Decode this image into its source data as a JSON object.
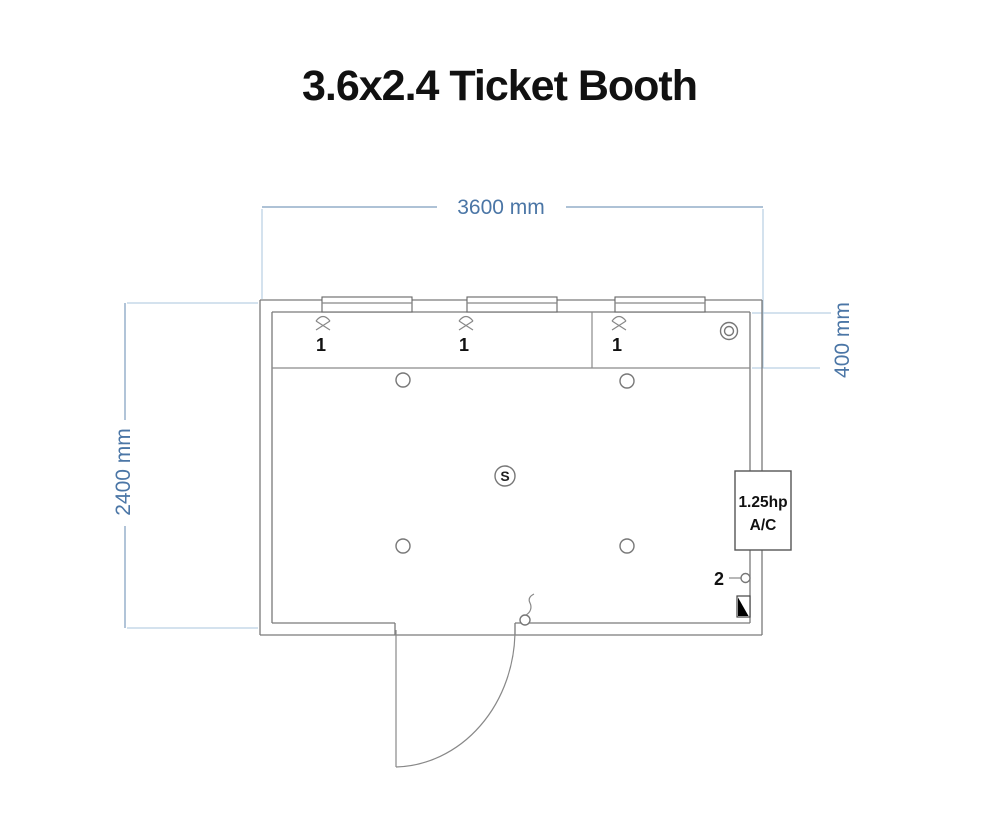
{
  "page": {
    "title": "3.6x2.4 Ticket Booth"
  },
  "dimensions": {
    "width_label": "3600 mm",
    "height_label": "2400 mm",
    "counter_depth_label": "400 mm"
  },
  "windows": [
    {
      "tag": "1"
    },
    {
      "tag": "1"
    },
    {
      "tag": "1"
    }
  ],
  "electrical": {
    "switch_label": "S",
    "outlet_tag": "2"
  },
  "ac_unit": {
    "line1": "1.25hp",
    "line2": "A/C"
  },
  "colors": {
    "dimension_text": "#4b76a6",
    "dimension_line": "#7d9dbd",
    "extension_line": "#aac6dc",
    "wall_line": "#7a7a7a",
    "label_text": "#111111"
  }
}
